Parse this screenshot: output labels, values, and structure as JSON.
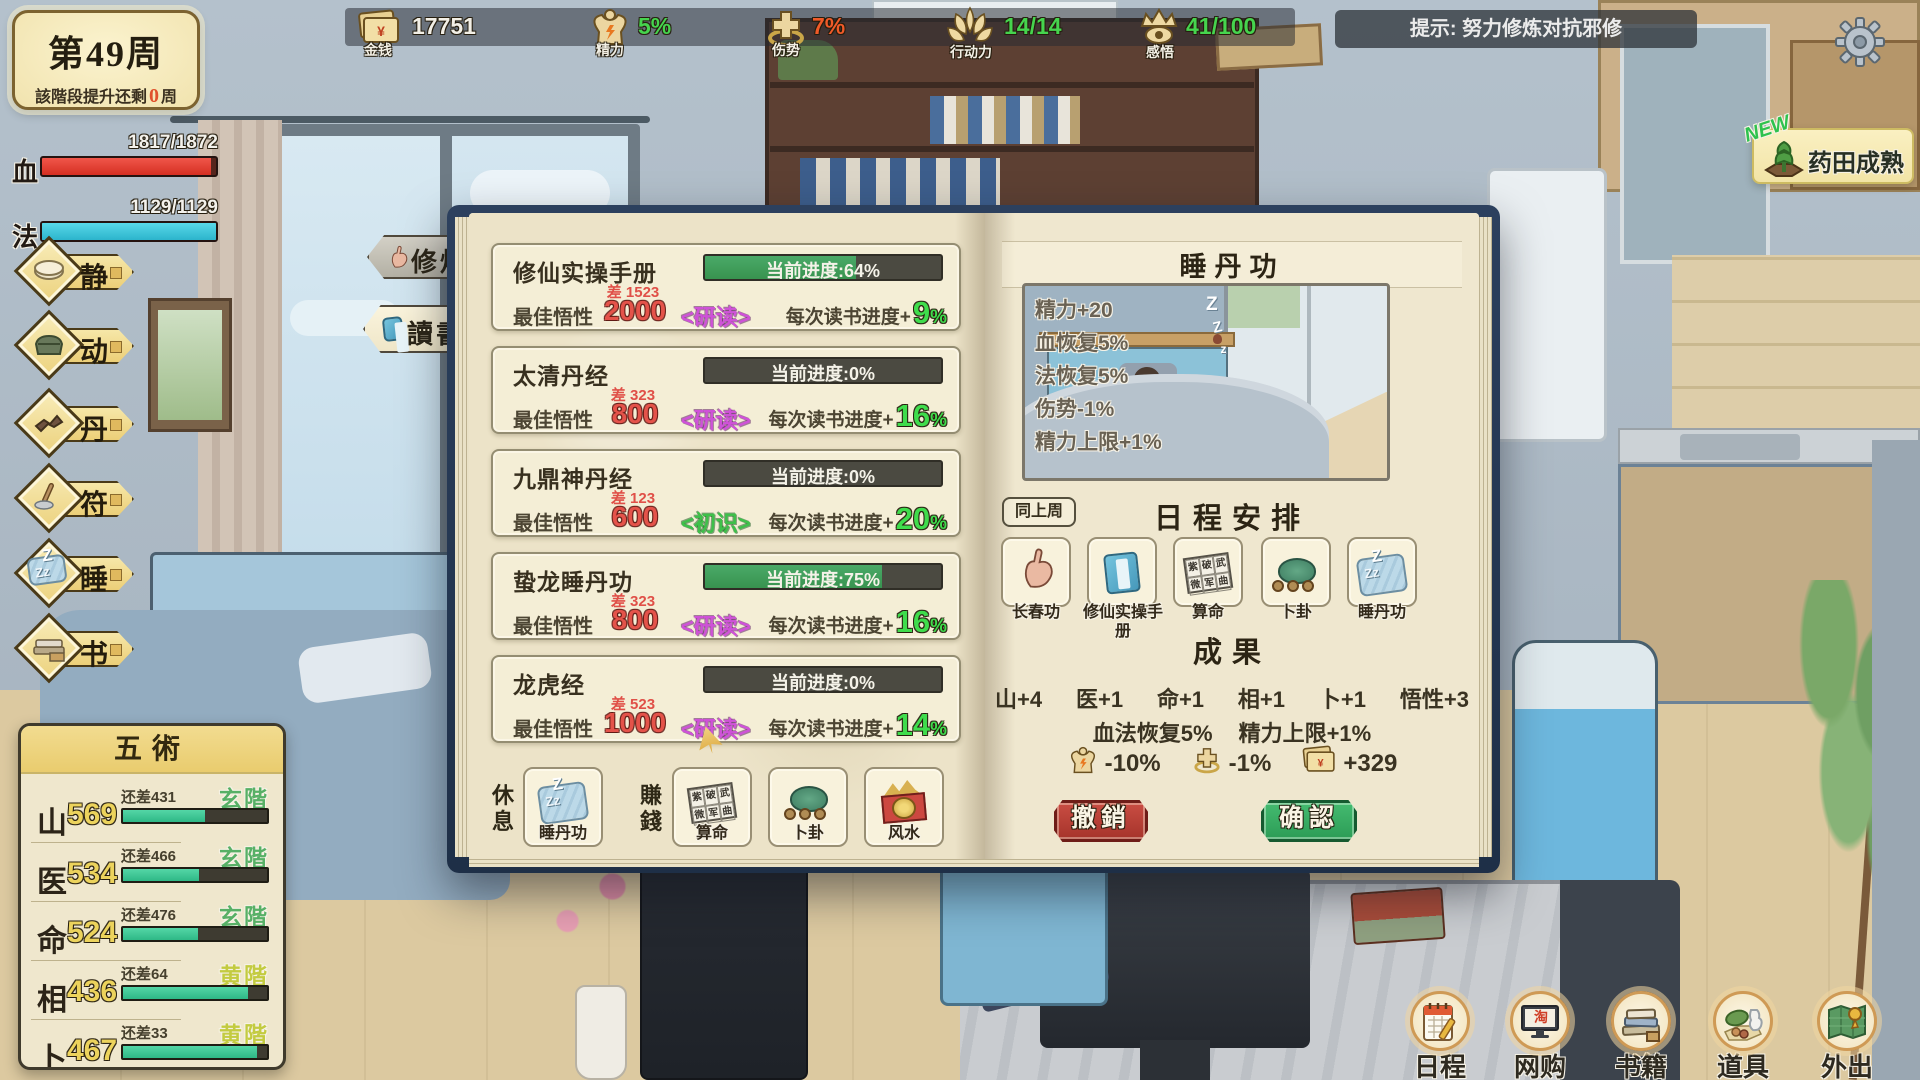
{
  "week_badge": {
    "title": "第49周",
    "line_prefix": "該階段提升还剩",
    "line_value": "0",
    "line_suffix": "周"
  },
  "vitals": {
    "hp": {
      "label": "血",
      "value": "1817/1872",
      "pct": 97,
      "color": "#e43a2c"
    },
    "mp": {
      "label": "法",
      "value": "1129/1129",
      "pct": 100,
      "color": "#3ec3d8"
    }
  },
  "top_resources": {
    "money": {
      "label": "金钱",
      "value": "17751",
      "icon": "money-cards-icon",
      "value_color": "#f2efe6"
    },
    "energy": {
      "label": "精力",
      "value": "5%",
      "icon": "muscle-icon",
      "value_color": "#46d44e"
    },
    "injury": {
      "label": "伤势",
      "value": "7%",
      "icon": "cross-icon",
      "value_color": "#f05a28"
    },
    "action": {
      "label": "行动力",
      "value": "14/14",
      "icon": "lotus-icon",
      "value_color": "#46d44e"
    },
    "insight": {
      "label": "感悟",
      "value": "41/100",
      "icon": "insight-eye-icon",
      "value_color": "#46d44e"
    }
  },
  "tip_bar": {
    "text": "提示: 努力修炼对抗邪修"
  },
  "harvest_toast": {
    "badge": "NEW",
    "text": "药田成熟",
    "icon": "herb-field-icon"
  },
  "sidebar": {
    "items": [
      {
        "label": "静",
        "icon": "cushion-icon"
      },
      {
        "label": "动",
        "icon": "bag-icon"
      },
      {
        "label": "丹",
        "icon": "herb-root-icon"
      },
      {
        "label": "符",
        "icon": "brush-icon"
      },
      {
        "label": "睡",
        "icon": "blanket-icon"
      },
      {
        "label": "书",
        "icon": "books-icon"
      }
    ]
  },
  "five_arts": {
    "title": "五術",
    "rows": [
      {
        "label": "山",
        "value": "569",
        "remain": "还差431",
        "tier": "玄階",
        "tier_color": "green",
        "pct": 57
      },
      {
        "label": "医",
        "value": "534",
        "remain": "还差466",
        "tier": "玄階",
        "tier_color": "green",
        "pct": 53
      },
      {
        "label": "命",
        "value": "524",
        "remain": "还差476",
        "tier": "玄階",
        "tier_color": "green",
        "pct": 52
      },
      {
        "label": "相",
        "value": "436",
        "remain": "还差64",
        "tier": "黄階",
        "tier_color": "yellow",
        "pct": 87
      },
      {
        "label": "卜",
        "value": "467",
        "remain": "还差33",
        "tier": "黄階",
        "tier_color": "yellow",
        "pct": 93
      }
    ]
  },
  "book_tabs": {
    "cultivate": {
      "label": "修煉",
      "icon": "hand-sign-icon"
    },
    "read": {
      "label": "讀書",
      "icon": "blue-book-icon",
      "active": true
    }
  },
  "books": {
    "items": [
      {
        "title": "修仙实操手册",
        "progress_label": "当前进度:64%",
        "progress_pct": 64,
        "diff": "差 1523",
        "aptitude_label": "最佳悟性",
        "aptitude": "2000",
        "mode": "<研读>",
        "mode_type": "study",
        "gain_label": "每次读书进度+",
        "gain": "9",
        "gain_unit": "%"
      },
      {
        "title": "太清丹经",
        "progress_label": "当前进度:0%",
        "progress_pct": 0,
        "diff": "差 323",
        "aptitude_label": "最佳悟性",
        "aptitude": "800",
        "mode": "<研读>",
        "mode_type": "study",
        "gain_label": "每次读书进度+",
        "gain": "16",
        "gain_unit": "%"
      },
      {
        "title": "九鼎神丹经",
        "progress_label": "当前进度:0%",
        "progress_pct": 0,
        "diff": "差 123",
        "aptitude_label": "最佳悟性",
        "aptitude": "600",
        "mode": "<初识>",
        "mode_type": "first",
        "gain_label": "每次读书进度+",
        "gain": "20",
        "gain_unit": "%"
      },
      {
        "title": "蛰龙睡丹功",
        "progress_label": "当前进度:75%",
        "progress_pct": 75,
        "diff": "差 323",
        "aptitude_label": "最佳悟性",
        "aptitude": "800",
        "mode": "<研读>",
        "mode_type": "study",
        "gain_label": "每次读书进度+",
        "gain": "16",
        "gain_unit": "%"
      },
      {
        "title": "龙虎经",
        "progress_label": "当前进度:0%",
        "progress_pct": 0,
        "diff": "差 523",
        "aptitude_label": "最佳悟性",
        "aptitude": "1000",
        "mode": "<研读>",
        "mode_type": "study",
        "gain_label": "每次读书进度+",
        "gain": "14",
        "gain_unit": "%"
      }
    ]
  },
  "activity_row": {
    "rest_label": "休息",
    "rest_card": {
      "label": "睡丹功",
      "icon": "sleep-blanket-icon"
    },
    "earn_label": "賺錢",
    "earn_cards": [
      {
        "label": "算命",
        "icon": "fortune-paper-icon"
      },
      {
        "label": "卜卦",
        "icon": "turtle-coins-icon"
      },
      {
        "label": "风水",
        "icon": "fengshui-compass-icon"
      }
    ]
  },
  "fortune_chars": [
    "紫",
    "破",
    "武",
    "微",
    "军",
    "曲"
  ],
  "detail": {
    "title": "睡丹功",
    "effects": [
      "精力+20",
      "血恢复5%",
      "法恢复5%",
      "伤势-1%",
      "精力上限+1%"
    ],
    "same_week_btn": "同上周",
    "schedule_title": "日程安排",
    "schedule_cards": [
      {
        "label": "长春功",
        "icon": "hand-sign-icon"
      },
      {
        "label": "修仙实操手册",
        "icon": "blue-book-icon"
      },
      {
        "label": "算命",
        "icon": "fortune-paper-icon"
      },
      {
        "label": "卜卦",
        "icon": "turtle-coins-icon"
      },
      {
        "label": "睡丹功",
        "icon": "sleep-blanket-icon"
      }
    ],
    "results_title": "成果",
    "gains": [
      "山+4",
      "医+1",
      "命+1",
      "相+1",
      "卜+1",
      "悟性+3"
    ],
    "effects_summary": [
      "血法恢复5%",
      "精力上限+1%"
    ],
    "costs": [
      {
        "icon": "muscle-icon",
        "value": "-10%"
      },
      {
        "icon": "cross-icon",
        "value": "-1%"
      },
      {
        "icon": "money-cards-icon",
        "value": "+329"
      }
    ],
    "cancel_btn": "撤銷",
    "confirm_btn": "确認"
  },
  "bottom_nav": {
    "items": [
      {
        "label": "日程",
        "icon": "calendar-icon"
      },
      {
        "label": "网购",
        "icon": "shopping-monitor-icon",
        "screen_char": "淘"
      },
      {
        "label": "书籍",
        "icon": "book-stack-icon"
      },
      {
        "label": "道具",
        "icon": "items-icon"
      },
      {
        "label": "外出",
        "icon": "map-pin-icon"
      }
    ]
  },
  "colors": {
    "progress_green": "#3fa05c",
    "gain_green": "#3fdc4c",
    "red_value": "#e4534a",
    "mode_study": "#cf52d8",
    "mode_first": "#3ec04a",
    "tier_green": "#57b066",
    "tier_yellow": "#c3cb40",
    "hp_red": "#e43a2c",
    "mp_cyan": "#3ec3d8",
    "five_bar_teal": "#36c08f",
    "confirm_green": "#3cb468",
    "cancel_red": "#bf4038"
  }
}
